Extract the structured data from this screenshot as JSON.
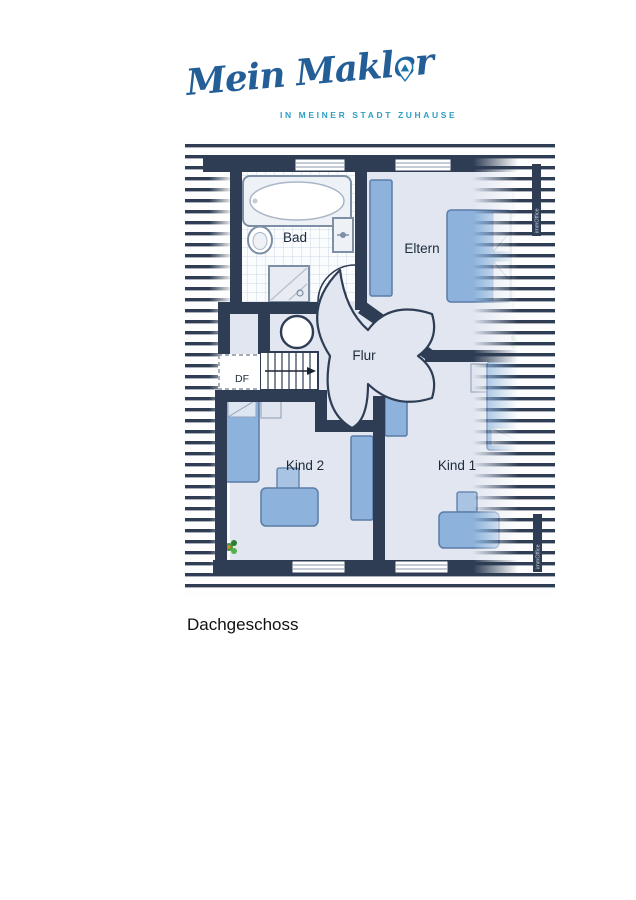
{
  "logo": {
    "brand": "Mein Makler",
    "tagline": "IN MEINER STADT ZUHAUSE",
    "pin_icon": "location-pin",
    "brand_color": "#235e97",
    "tagline_color": "#2f9fc4"
  },
  "caption": "Dachgeschoss",
  "plan": {
    "labels": {
      "bad": "Bad",
      "eltern": "Eltern",
      "flur": "Flur",
      "kind2": "Kind 2",
      "kind1": "Kind 1",
      "df": "DF"
    },
    "watermark": "immOffice",
    "rooms": [
      {
        "name": "Bad",
        "features": [
          "bathtub",
          "wc",
          "washbasin",
          "shower",
          "tiled-floor",
          "door"
        ]
      },
      {
        "name": "Eltern",
        "features": [
          "double-bed",
          "two-nightstands",
          "wardrobe",
          "plant",
          "window"
        ]
      },
      {
        "name": "Flur",
        "features": [
          "four-door-star",
          "stairs-down",
          "round-opening"
        ]
      },
      {
        "name": "Kind 2",
        "features": [
          "bed",
          "wardrobe",
          "desk",
          "chair",
          "plant",
          "window"
        ]
      },
      {
        "name": "Kind 1",
        "features": [
          "bed",
          "wardrobe",
          "desk",
          "chair",
          "window"
        ]
      }
    ],
    "stairs": {
      "direction_arrow": "right",
      "treads": 7
    },
    "colors": {
      "wall": "#2e3d54",
      "floor": "#e1e6f0",
      "furniture_blue": "#8db3dc",
      "furniture_border": "#5a7ca6",
      "furniture_light": "#dbe2ee",
      "tile_line": "#ccd8e5",
      "plant_green": "#3f9d3f",
      "hatch": "#2e3d54"
    }
  }
}
